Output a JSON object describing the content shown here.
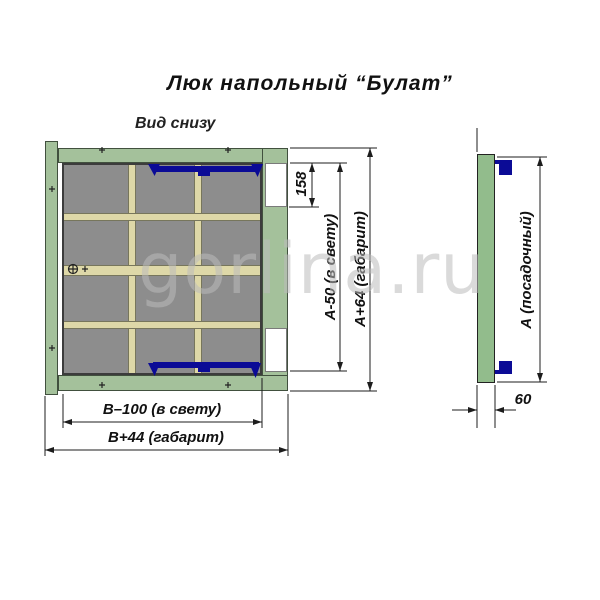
{
  "title": "Люк напольный “Булат”",
  "view_label": "Вид снизу",
  "watermark": "gorlina.ru",
  "dims": {
    "hinge_offset": "158",
    "height_clear": "А-50 (в свету)",
    "height_overall": "А+64 (габарит)",
    "width_clear": "В–100 (в свету)",
    "width_overall": "В+44 (габарит)",
    "seat_height": "А (посадочный)",
    "frame_depth": "60"
  },
  "colors": {
    "frame_green": "#a4c19b",
    "side_view_green": "#92bc8c",
    "panel_gray": "#8d8d8d",
    "stiffener_beige": "#ded8a8",
    "latch_blue": "#0b0b96",
    "dimension_line": "#1c1c1c",
    "watermark_gray": "#bcbcbc"
  }
}
